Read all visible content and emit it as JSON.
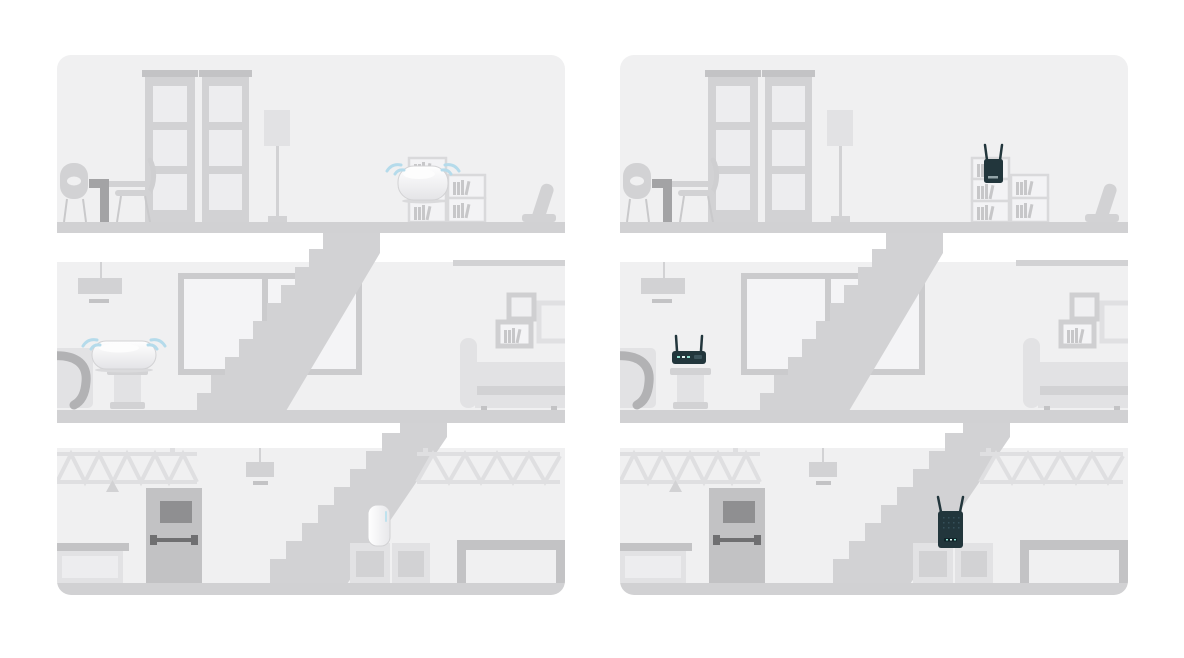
{
  "scene": {
    "description_visible_text": "",
    "left_panel": {
      "name": "mesh-wifi-home-illustration",
      "devices": [
        {
          "icon": "mesh-node-icon",
          "floor": "top",
          "wifi_waves": true
        },
        {
          "icon": "mesh-node-icon",
          "floor": "middle",
          "wifi_waves": true
        },
        {
          "icon": "mesh-tower-node-icon",
          "floor": "bottom",
          "wifi_waves": false
        }
      ]
    },
    "right_panel": {
      "name": "router-extender-home-illustration",
      "devices": [
        {
          "icon": "range-extender-icon",
          "floor": "top",
          "wifi_waves": false
        },
        {
          "icon": "wifi-router-icon",
          "floor": "middle",
          "wifi_waves": false
        },
        {
          "icon": "range-extender-icon",
          "floor": "bottom",
          "wifi_waves": false
        }
      ]
    }
  },
  "colors": {
    "page_bg": "#ffffff",
    "panel_bg": "#f0f0f1",
    "floor": "#d1d1d3",
    "stair": "#d2d2d4",
    "furn_light": "#e2e2e4",
    "furn_lighter": "#ededef",
    "furn_mid": "#d2d2d4",
    "furn_middark": "#c3c3c5",
    "furn_dark": "#a3a3a5",
    "door": "#c2c2c4",
    "door_window": "#8f8f91",
    "push_bar": "#6f6f71",
    "device_dark": "#22363c",
    "wifi_blue": "#b5dbeb",
    "led_teal": "#8fe0d0"
  }
}
